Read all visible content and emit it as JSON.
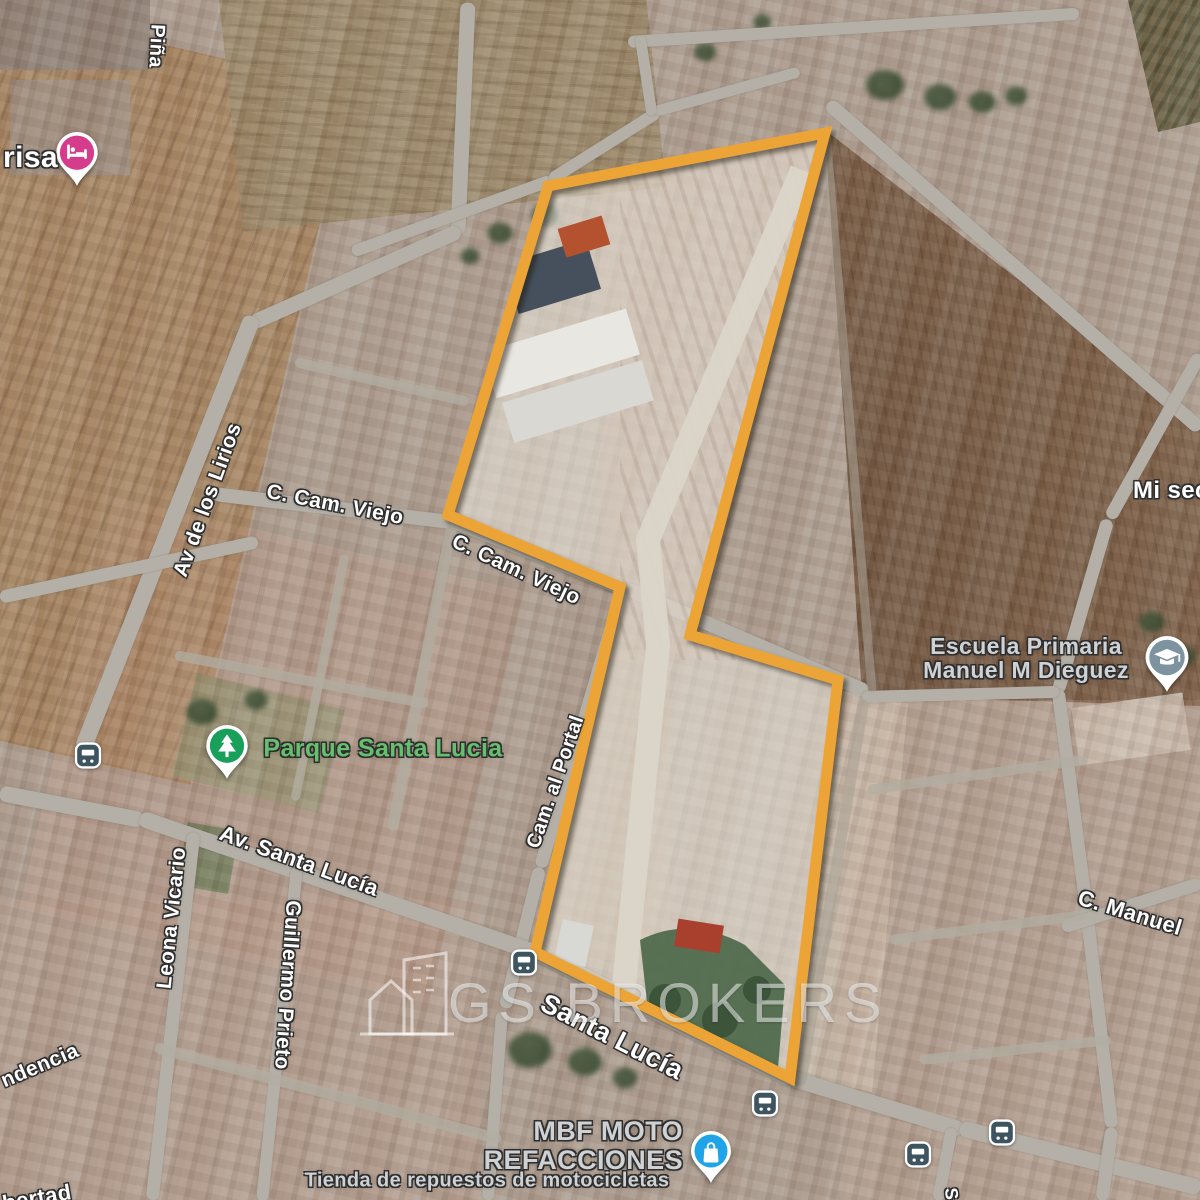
{
  "labels": {
    "pina": "Piña",
    "lirios": "Av de los Lirios",
    "cam_viejo_1": "C. Cam. Viejo",
    "cam_viejo_2": "C. Cam. Viejo",
    "cam_al_portal": "Cam. al Portal",
    "av_santa_lucia": "Av. Santa Lucía",
    "leona_vicario": "Leona Vicario",
    "guillermo_prieto": "Guillermo Prieto",
    "santa_lucia": "Santa Lucía",
    "independencia_partial": "ndencia",
    "libertad_partial": "bertad",
    "c_manuel": "C. Manuel",
    "mi_sec_partial": "Mi sec",
    "s_partial": "S"
  },
  "pois": {
    "hotel_label_partial": "risa",
    "park": "Parque Santa Lucia",
    "school_line1": "Escuela Primaria",
    "school_line2": "Manuel M Dieguez",
    "shop_line1": "MBF MOTO",
    "shop_line2": "REFACCIONES",
    "shop_subtitle": "Tienda de repuestos de motocicletas"
  },
  "watermark": {
    "text": "GS BROKERS"
  },
  "colors": {
    "parcel_outline": "#ECA437",
    "hotel_pin": "#D63C8C",
    "park_pin": "#18A05A",
    "school_pin": "#7E93A0",
    "shop_pin": "#1FA4E8",
    "bus_icon": "#3E5560",
    "park_label_text": "#66BE6F"
  }
}
